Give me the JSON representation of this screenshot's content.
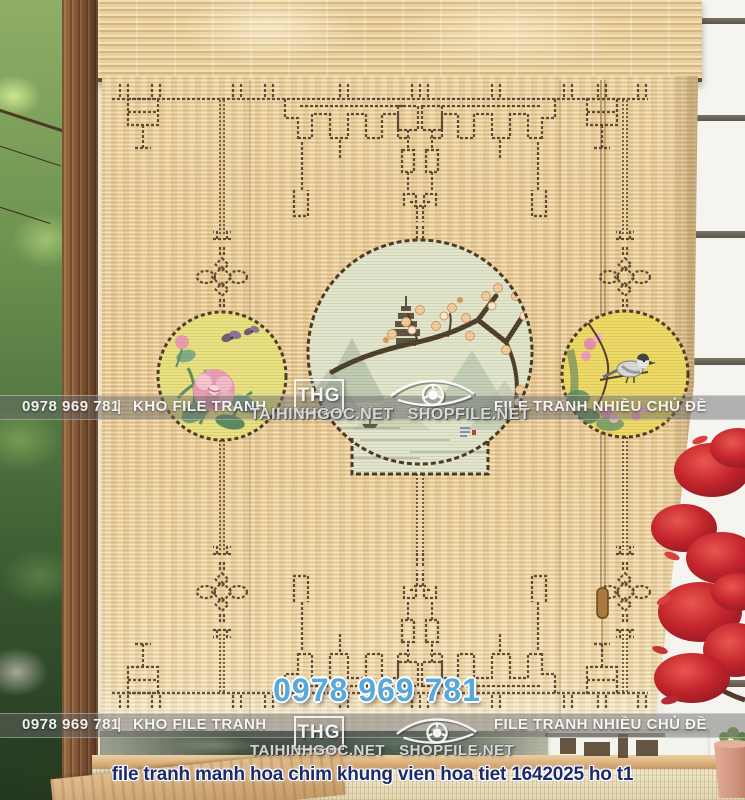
{
  "watermark_bar": {
    "phone": "0978 969 781",
    "divider": "|",
    "store": "KHO FILE TRANH",
    "tagline": "FILE TRANH NHIỀU CHỦ ĐỀ"
  },
  "brand": {
    "logo_text": "THG",
    "site_primary": "TAIHINHGOC.NET",
    "site_secondary": "SHOPFILE.NET",
    "phone_large": "0978 969 781"
  },
  "caption": {
    "text": "file tranh manh hoa chim khung vien hoa tiet 1642025 ho t1"
  },
  "colors": {
    "blind_tan": "#ecd09c",
    "lattice_brown": "#4f3b23",
    "accent_blue": "#58a9db",
    "caption_navy": "#1c2b6e",
    "maple_red": "#c0252e",
    "circle_left_bg": "#e9e282",
    "circle_right_bg": "#eeda66",
    "center_painting_bg": "#e1e6ce",
    "watermark_bar_overlay": "#696969"
  },
  "icons": {
    "watermark_logo": "eye-logo-icon",
    "logo_box": "thg-logo-box"
  }
}
